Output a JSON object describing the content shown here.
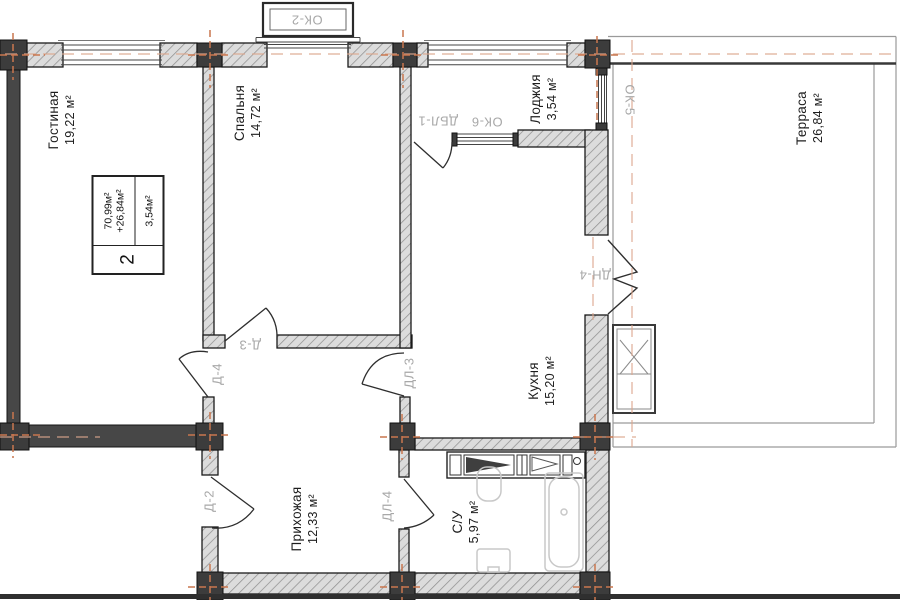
{
  "title": "Floor plan of 2-room apartment",
  "unit_stamp": {
    "rooms_count": "2",
    "area_main": "70,99м²",
    "area_plus": "+26,84м²",
    "area_extra": "3,54м²"
  },
  "rooms": [
    {
      "name": "Гостиная",
      "area": "19,22 м²"
    },
    {
      "name": "Спальня",
      "area": "14,72 м²"
    },
    {
      "name": "Лоджия",
      "area": "3,54 м²"
    },
    {
      "name": "Кухня",
      "area": "15,20 м²"
    },
    {
      "name": "Терраса",
      "area": "26,84 м²"
    },
    {
      "name": "Прихожая",
      "area": "12,33 м²"
    },
    {
      "name": "С/У",
      "area": "5,97 м²"
    }
  ],
  "openings": {
    "ok2": "ОК-2",
    "ok5": "ОК-5",
    "ok6": "ОК-6",
    "dbl1": "ДБЛ-1",
    "dn4": "ДН-4",
    "d2": "Д-2",
    "d3": "Д-3",
    "d4": "Д-4",
    "dl3": "ДЛ-3",
    "dl4": "ДЛ-4"
  },
  "colors": {
    "axis_cross": "#c9764e",
    "axis_line": "#dca68d",
    "tag_text": "#a8a8a8",
    "wall_dark": "#474747",
    "column_dark": "#3c3c3c",
    "ink": "#1d1d1d"
  }
}
